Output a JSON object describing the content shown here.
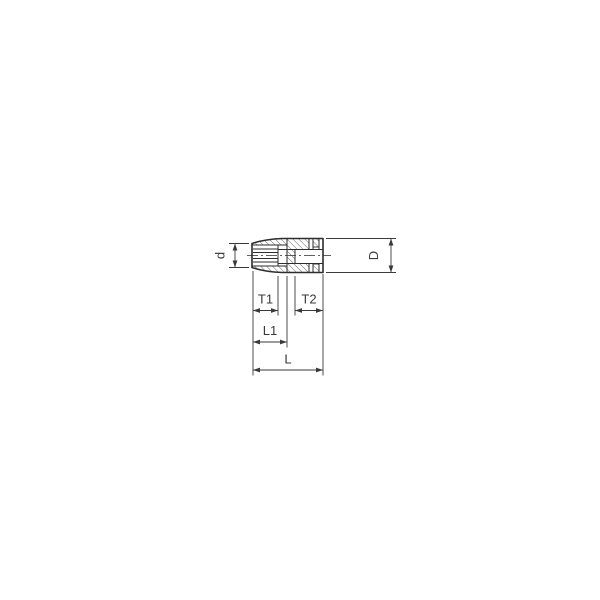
{
  "drawing": {
    "description": "Technical cross-section drawing of a deep socket (tool) with dimension callouts",
    "background_color": "#ffffff",
    "line_color": "#2d2d2d",
    "hatch_color": "#4a4a4a",
    "text_color": "#3a3a3a",
    "labels": {
      "d": "d",
      "D": "D",
      "T1": "T1",
      "T2": "T2",
      "L1": "L1",
      "L": "L"
    }
  }
}
